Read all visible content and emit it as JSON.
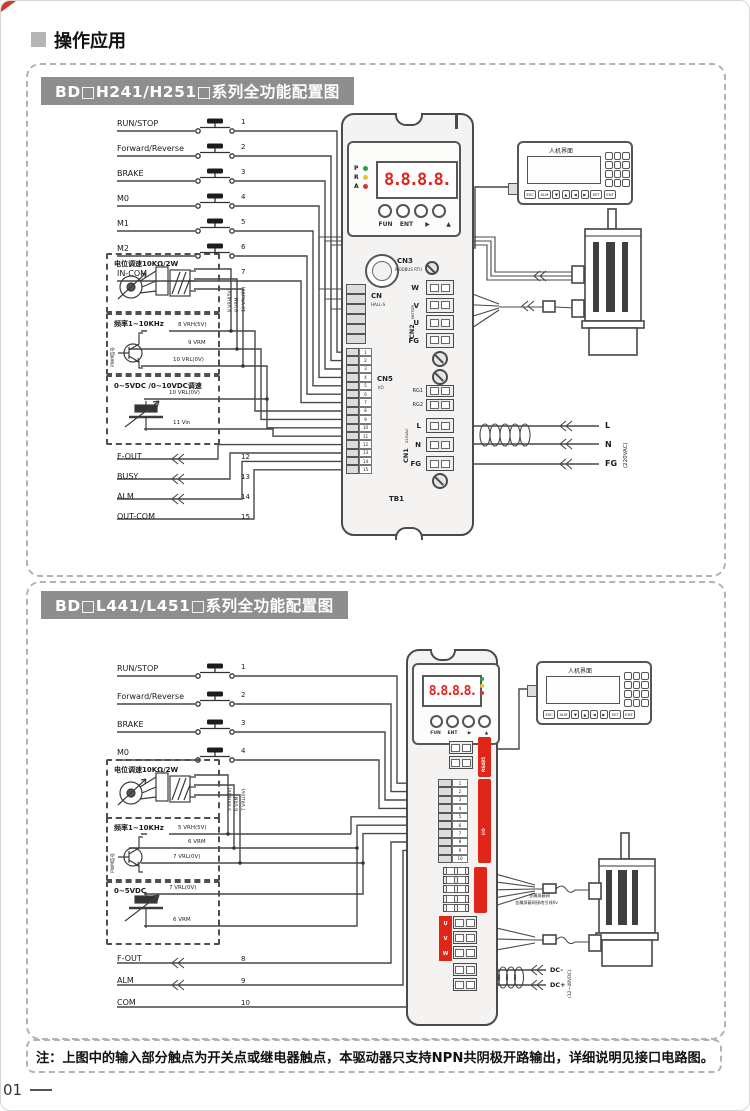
{
  "page": {
    "header_title": "操作应用",
    "page_number": "01",
    "note": "注：上图中的输入部分触点为开关点或继电器触点，本驱动器只支持NPN共阴极开路输出，详细说明见接口电路图。"
  },
  "d1": {
    "title": "BD□H241/H251□系列全功能配置图",
    "inputs": [
      {
        "label": "RUN/STOP",
        "pin": "1"
      },
      {
        "label": "Forward/Reverse",
        "pin": "2"
      },
      {
        "label": "BRAKE",
        "pin": "3"
      },
      {
        "label": "M0",
        "pin": "4"
      },
      {
        "label": "M1",
        "pin": "5"
      },
      {
        "label": "M2",
        "pin": "6"
      },
      {
        "label": "IN-COM",
        "pin": "7"
      }
    ],
    "pot_box_title": "电位调速10KΩ/2W",
    "pot_pins_rotated": [
      "8 VRH(5V)",
      "9 VRM",
      "10 VRL(0V)"
    ],
    "freq_box_title": "频率1~10KHz",
    "freq_side_label": "PWM信号",
    "freq_pins": [
      "8 VRH(5V)",
      "9 VRM",
      "10 VRL(0V)"
    ],
    "vdc_box_title": "0~5VDC /0~10VDC调速",
    "vdc_pins": [
      "10 VRL(0V)",
      "11 Vin"
    ],
    "outputs": [
      {
        "label": "F-OUT",
        "pin": "12"
      },
      {
        "label": "BUSY",
        "pin": "13"
      },
      {
        "label": "ALM",
        "pin": "14"
      },
      {
        "label": "OUT-COM",
        "pin": "15"
      }
    ],
    "driver": {
      "leds": [
        {
          "label": "P",
          "color": "#2f9e48"
        },
        {
          "label": "R",
          "color": "#e6c62e"
        },
        {
          "label": "A",
          "color": "#d43a32"
        }
      ],
      "display": "8.8.8.8.",
      "btn_labels": [
        "FUN",
        "ENT",
        "▶",
        "▲"
      ],
      "cn3": "CN3",
      "cn3_sub": "MODBUS RTU",
      "cn_hall": "CN",
      "cn_hall_sub": "HALL-S",
      "cn5": "CN5",
      "cn5_sub": "I/O",
      "cn5_pins": [
        "1",
        "2",
        "3",
        "4",
        "5",
        "6",
        "7",
        "8",
        "9",
        "10",
        "11",
        "12",
        "13",
        "14",
        "15"
      ],
      "cn2_rot": "CN2",
      "cn2_rot_sub": "MOTOR",
      "motor_pins": [
        "W",
        "V",
        "U",
        "FG"
      ],
      "rg_pins": [
        "RG1",
        "RG2"
      ],
      "cn1_rot": "CN1",
      "cn1_rot_sub": "220VAC",
      "ac_pins": [
        "L",
        "N",
        "FG"
      ],
      "tb1": "TB1"
    },
    "hmi": {
      "title": "人机界面",
      "keys": [
        "ESC",
        "ALM",
        "▼",
        "▲",
        "◀",
        "▶",
        "SET",
        "ENT"
      ]
    },
    "ac_voltage": "(220VAC)"
  },
  "d2": {
    "title": "BD□L441/L451□系列全功能配置图",
    "inputs": [
      {
        "label": "RUN/STOP",
        "pin": "1"
      },
      {
        "label": "Forward/Reverse",
        "pin": "2"
      },
      {
        "label": "BRAKE",
        "pin": "3"
      },
      {
        "label": "M0",
        "pin": "4"
      }
    ],
    "pot_box_title": "电位调速10KΩ/2W",
    "pot_pins_rotated": [
      "5 VRH(5V)",
      "6 VRM",
      "7 VRL(0V)"
    ],
    "freq_box_title": "频率1~10KHz",
    "freq_side_label": "PWM信号",
    "freq_pins": [
      "5 VRH(5V)",
      "6 VRM",
      "7 VRL(0V)"
    ],
    "vdc_box_title": "0~5VDC",
    "vdc_pins": [
      "7 VRL(0V)",
      "6 VRM"
    ],
    "outputs": [
      {
        "label": "F-OUT",
        "pin": "8"
      },
      {
        "label": "ALM",
        "pin": "9"
      },
      {
        "label": "COM",
        "pin": "10"
      }
    ],
    "driver": {
      "display": "8.8.8.8.",
      "btn_labels": [
        "FUN",
        "ENT",
        "▶",
        "▲"
      ],
      "io_pins": [
        "1",
        "2",
        "3",
        "4",
        "5",
        "6",
        "7",
        "8",
        "9",
        "10"
      ],
      "rs485_label": "RS485",
      "io_label": "I/O",
      "uvw": [
        "U",
        "V",
        "W"
      ]
    },
    "hmi": {
      "title": "人机界面",
      "keys": [
        "ESC",
        "ALM",
        "▼",
        "▲",
        "◀",
        "▶",
        "SET",
        "ENT"
      ]
    },
    "shield_line1": "金属屏蔽网",
    "shield_line2": "金属屏蔽网接地引线0v",
    "dc_labels": [
      "DC-",
      "DC+"
    ],
    "dc_voltage": "(12~48VDC)",
    "ac_outer": []
  },
  "d1_ac_outer": [
    "L",
    "N",
    "FG"
  ]
}
